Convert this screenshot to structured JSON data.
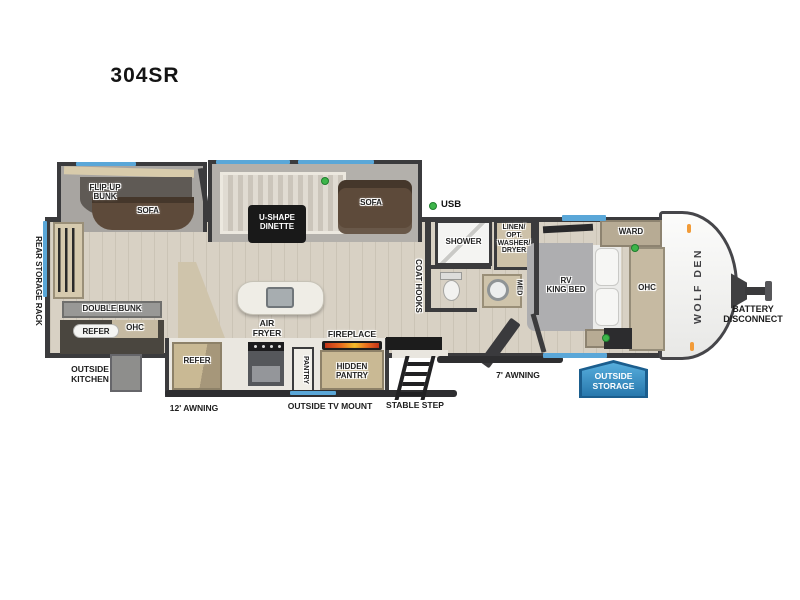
{
  "title": "304SR",
  "brand": "WOLF DEN",
  "legend": {
    "usb": "USB"
  },
  "labels": {
    "flip_up_bunk": "FLIP-UP\nBUNK",
    "sofa_left": "SOFA",
    "dinette": "U-SHAPE\nDINETTE",
    "sofa_right": "SOFA",
    "rear_storage_rack": "REAR STORAGE RACK",
    "double_bunk": "DOUBLE BUNK",
    "refer_rear": "REFER",
    "ohc_rear": "OHC",
    "outside_kitchen": "OUTSIDE\nKITCHEN",
    "awning_12": "12' AWNING",
    "refer_kitchen": "REFER",
    "air_fryer": "AIR\nFRYER",
    "pantry": "PANTRY",
    "hidden_pantry": "HIDDEN\nPANTRY",
    "fireplace": "FIREPLACE",
    "outside_tv_mount": "OUTSIDE TV MOUNT",
    "stable_step": "STABLE STEP",
    "coat_hooks": "COAT HOOKS",
    "shower": "SHOWER",
    "linen": "LINEN/\nOPT.\nWASHER/\nDRYER",
    "med": "MED",
    "king_bed": "RV\nKING BED",
    "ward": "WARD",
    "ohc_bedroom": "OHC",
    "awning_7": "7' AWNING",
    "outside_storage": "OUTSIDE\nSTORAGE",
    "battery_disconnect": "BATTERY\nDISCONNECT"
  },
  "colors": {
    "wall": "#3b3b3d",
    "floor_wood": "#d8d1c4",
    "slide_floor": "#b3b0ab",
    "window_accent": "#5aa7d8",
    "usb_dot": "#3db54a",
    "sofa_brown": "#5d4a3a",
    "cabinet_tan": "#c9b994",
    "badge_blue": "#2f85bd",
    "flame_orange": "#e96c1e"
  }
}
